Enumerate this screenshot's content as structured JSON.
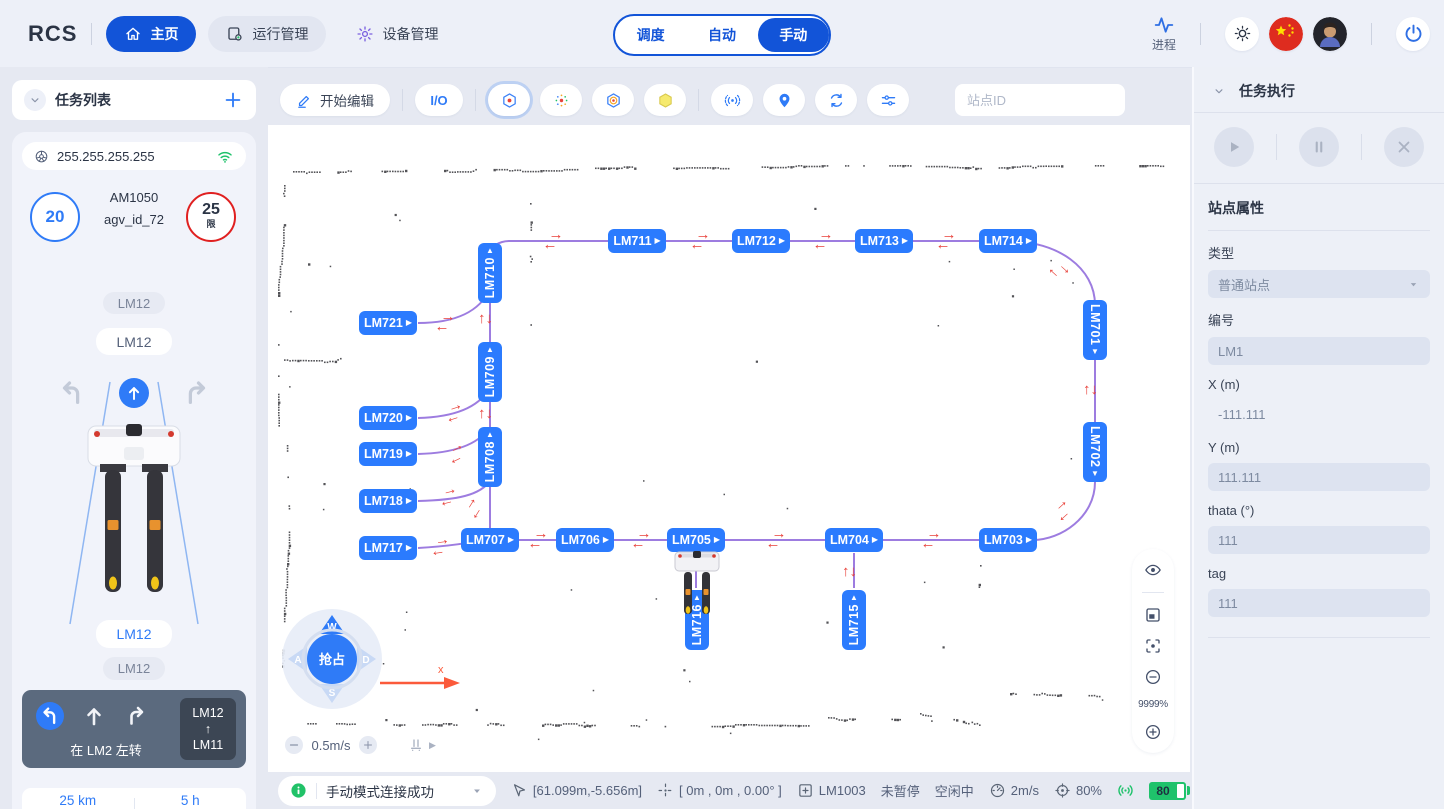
{
  "navbar": {
    "logo": "RCS",
    "items": [
      {
        "label": "主页"
      },
      {
        "label": "运行管理"
      },
      {
        "label": "设备管理"
      }
    ],
    "modes": [
      "调度",
      "自动",
      "手动"
    ],
    "active_mode": "手动",
    "process_label": "进程"
  },
  "task_list": {
    "title": "任务列表",
    "ip": "255.255.255.255",
    "vehicle": {
      "speed": "20",
      "model": "AM1050",
      "agv_id": "agv_id_72",
      "limit": "25",
      "limit_suffix": "限",
      "badge1": "LM12",
      "badge2": "LM12",
      "badge3": "LM12",
      "badge4": "LM12"
    },
    "hint": {
      "text": "在 LM2 左转",
      "from": "LM12",
      "arrow": "↑",
      "to": "LM11"
    },
    "stats": {
      "trip_km": "25 km",
      "total_km": "650 km",
      "trip_h": "5 h",
      "total_h": "850 h"
    }
  },
  "toolbar": {
    "edit_label": "开始编辑",
    "io_label": "I/O",
    "search_placeholder": "站点ID"
  },
  "map": {
    "zoom_label": "9999%",
    "speed_control": "0.5m/s",
    "axis_label": "x",
    "joystick": {
      "up": "W",
      "left": "A",
      "down": "S",
      "right": "D",
      "center": "抢占"
    },
    "accent_colors": {
      "station": "#2b7bfe",
      "path": "#9d7ce0",
      "arrow": "#e8413a"
    },
    "stations": [
      {
        "id": "LM711",
        "x": 369,
        "y": 116,
        "o": "h"
      },
      {
        "id": "LM712",
        "x": 493,
        "y": 116,
        "o": "h"
      },
      {
        "id": "LM713",
        "x": 616,
        "y": 116,
        "o": "h"
      },
      {
        "id": "LM714",
        "x": 740,
        "y": 116,
        "o": "h"
      },
      {
        "id": "LM710",
        "x": 222,
        "y": 148,
        "o": "vup"
      },
      {
        "id": "LM721",
        "x": 120,
        "y": 198,
        "o": "h"
      },
      {
        "id": "LM709",
        "x": 222,
        "y": 247,
        "o": "vup"
      },
      {
        "id": "LM720",
        "x": 120,
        "y": 293,
        "o": "h"
      },
      {
        "id": "LM719",
        "x": 120,
        "y": 329,
        "o": "h"
      },
      {
        "id": "LM708",
        "x": 222,
        "y": 332,
        "o": "vup"
      },
      {
        "id": "LM718",
        "x": 120,
        "y": 376,
        "o": "h"
      },
      {
        "id": "LM717",
        "x": 120,
        "y": 423,
        "o": "h"
      },
      {
        "id": "LM707",
        "x": 222,
        "y": 415,
        "o": "h"
      },
      {
        "id": "LM706",
        "x": 317,
        "y": 415,
        "o": "h"
      },
      {
        "id": "LM705",
        "x": 428,
        "y": 415,
        "o": "h"
      },
      {
        "id": "LM704",
        "x": 586,
        "y": 415,
        "o": "h"
      },
      {
        "id": "LM703",
        "x": 740,
        "y": 415,
        "o": "h"
      },
      {
        "id": "LM701",
        "x": 827,
        "y": 205,
        "o": "vdown"
      },
      {
        "id": "LM702",
        "x": 827,
        "y": 327,
        "o": "vdown"
      },
      {
        "id": "LM715",
        "x": 586,
        "y": 495,
        "o": "vup"
      },
      {
        "id": "LM716",
        "x": 429,
        "y": 495,
        "o": "vup"
      }
    ],
    "paths": [
      "M 222 420 L 222 136 Q 222 116 242 116 L 740 116 C 790 116 827 143 827 180 L 827 357 C 827 392 793 415 765 415 L 222 415",
      "M 150 198 C 188 198 212 186 222 164",
      "M 150 293 C 190 292 211 281 221 264",
      "M 150 329 C 190 328 211 318 221 303",
      "M 150 376 C 190 375 212 370 222 356",
      "M 150 423 C 185 421 205 417 222 414",
      "M 428 428 L 428 463",
      "M 586 428 L 586 463"
    ],
    "arrows": [
      {
        "x": 285,
        "y": 116,
        "t": "h",
        "r": 0
      },
      {
        "x": 432,
        "y": 116,
        "t": "h",
        "r": 0
      },
      {
        "x": 555,
        "y": 116,
        "t": "h",
        "r": 0
      },
      {
        "x": 678,
        "y": 116,
        "t": "h",
        "r": 0
      },
      {
        "x": 177,
        "y": 198,
        "t": "h",
        "r": 0
      },
      {
        "x": 222,
        "y": 194,
        "t": "v",
        "r": 0
      },
      {
        "x": 222,
        "y": 289,
        "t": "v",
        "r": 0
      },
      {
        "x": 827,
        "y": 265,
        "t": "v",
        "r": 0
      },
      {
        "x": 586,
        "y": 447,
        "t": "v",
        "r": 0
      },
      {
        "x": 792,
        "y": 146,
        "t": "h",
        "r": 42
      },
      {
        "x": 794,
        "y": 386,
        "t": "h",
        "r": -42
      },
      {
        "x": 186,
        "y": 288,
        "t": "h",
        "r": -18
      },
      {
        "x": 188,
        "y": 329,
        "t": "h",
        "r": -26
      },
      {
        "x": 180,
        "y": 372,
        "t": "h",
        "r": -14
      },
      {
        "x": 205,
        "y": 384,
        "t": "h",
        "r": -58
      },
      {
        "x": 172,
        "y": 422,
        "t": "h",
        "r": -8
      },
      {
        "x": 270,
        "y": 415,
        "t": "h",
        "r": 0
      },
      {
        "x": 373,
        "y": 415,
        "t": "h",
        "r": 0
      },
      {
        "x": 508,
        "y": 415,
        "t": "h",
        "r": 0
      },
      {
        "x": 663,
        "y": 415,
        "t": "h",
        "r": 0
      }
    ],
    "robot_station": "LM716"
  },
  "task_exec": {
    "title": "任务执行"
  },
  "station_props": {
    "title": "站点属性",
    "type_label": "类型",
    "type_value": "普通站点",
    "id_label": "编号",
    "id_value": "LM1",
    "x_label": "X (m)",
    "x_value": "-111.111",
    "y_label": "Y (m)",
    "y_value": "111.111",
    "theta_label": "thata (°)",
    "theta_value": "111",
    "tag_label": "tag",
    "tag_value": "111"
  },
  "status_bar": {
    "message": "手动模式连接成功",
    "position": "[61.099m,-5.656m]",
    "pose": "[ 0m , 0m , 0.00° ]",
    "station": "LM1003",
    "pause_state": "未暂停",
    "idle_state": "空闲中",
    "speed": "2m/s",
    "percent": "80%",
    "battery": "80"
  }
}
